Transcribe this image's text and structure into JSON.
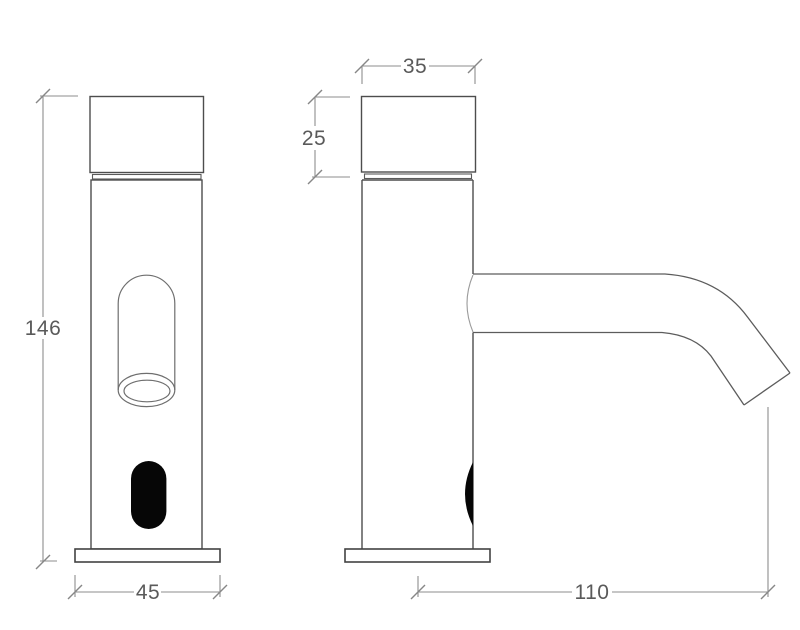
{
  "drawing": {
    "background": "#ffffff",
    "dimensions": {
      "overall_height": "146",
      "base_width": "45",
      "cap_width": "35",
      "cap_height": "25",
      "spout_reach": "110"
    },
    "colors": {
      "object_line": "#4d4d4d",
      "dimension_line": "#8e8e8e",
      "label_text": "#5a5a5a",
      "sensor_window_fill": "#060606"
    }
  }
}
